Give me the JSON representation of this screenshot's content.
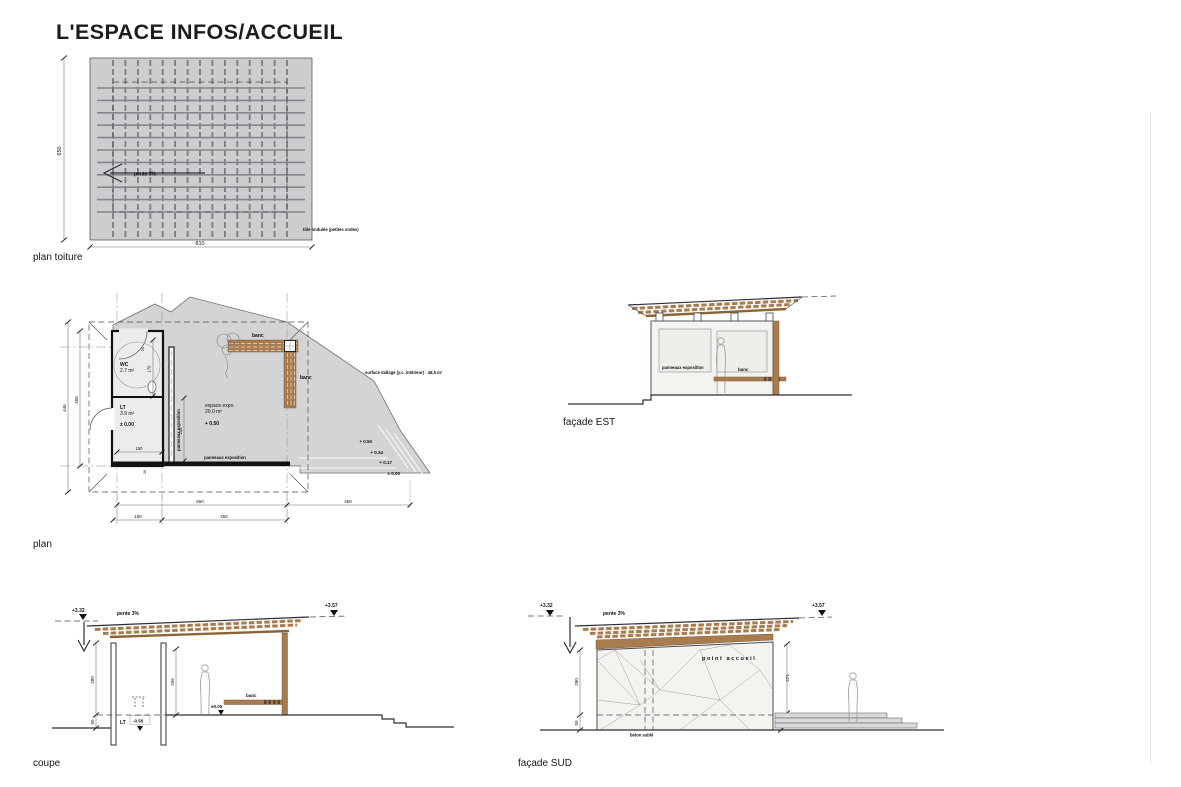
{
  "page": {
    "title": "L'ESPACE INFOS/ACCUEIL"
  },
  "colors": {
    "wood": "#a97c50",
    "roof_gray": "#cdcdd0",
    "paving_gray": "#d4d4d7",
    "wall_white": "#f4f3f0"
  },
  "roof_plan": {
    "label": "plan toiture",
    "slope_note": "pente 3%",
    "material_note": "tôle ondulée (petites ondes)",
    "dim_width": "810",
    "dim_height": "650"
  },
  "plan": {
    "label": "plan",
    "rooms": {
      "wc_name": "WC",
      "wc_area": "2.7 m²",
      "lt_name": "LT",
      "lt_area": "3.9 m²",
      "lt_level": "± 0.00",
      "expo_name": "espace expo.",
      "expo_area": "20.0 m²",
      "expo_level": "+ 0.50"
    },
    "labels": {
      "banc": "banc",
      "panneaux": "panneaux exposition",
      "surface_note": "surface dallage (y.c. intérieur) : 48,5 m²"
    },
    "levels": {
      "l1": "+ 0.50",
      "l2": "+ 0.34",
      "l3": "+ 0.17",
      "l4": "± 0.00"
    },
    "dims": {
      "d650": "650",
      "d450a": "450",
      "d180": "180",
      "d450b": "450",
      "d446": "446",
      "d466": "466",
      "d170": "170",
      "d246": "246",
      "d160": "160",
      "d20": "20"
    }
  },
  "facade_est": {
    "label": "façade EST",
    "panneaux": "panneaux exposition",
    "banc": "banc"
  },
  "coupe": {
    "label": "coupe",
    "level_left": "+3.32",
    "level_right": "+3.57",
    "slope_note": "pente 3%",
    "dim_height": "280",
    "dim_base": "50",
    "dim_clear": "256",
    "lt": "LT",
    "lt_level": "-0.50",
    "banc": "banc",
    "level_zero": "±0.00"
  },
  "facade_sud": {
    "label": "façade SUD",
    "level_left": "+3.32",
    "level_right": "+3.57",
    "slope_note": "pente 3%",
    "dim_height": "280",
    "dim_base_left": "50",
    "dim_right": "271",
    "dim_base_right": "50",
    "sign": "point accueil",
    "material_note": "béton sablé"
  }
}
